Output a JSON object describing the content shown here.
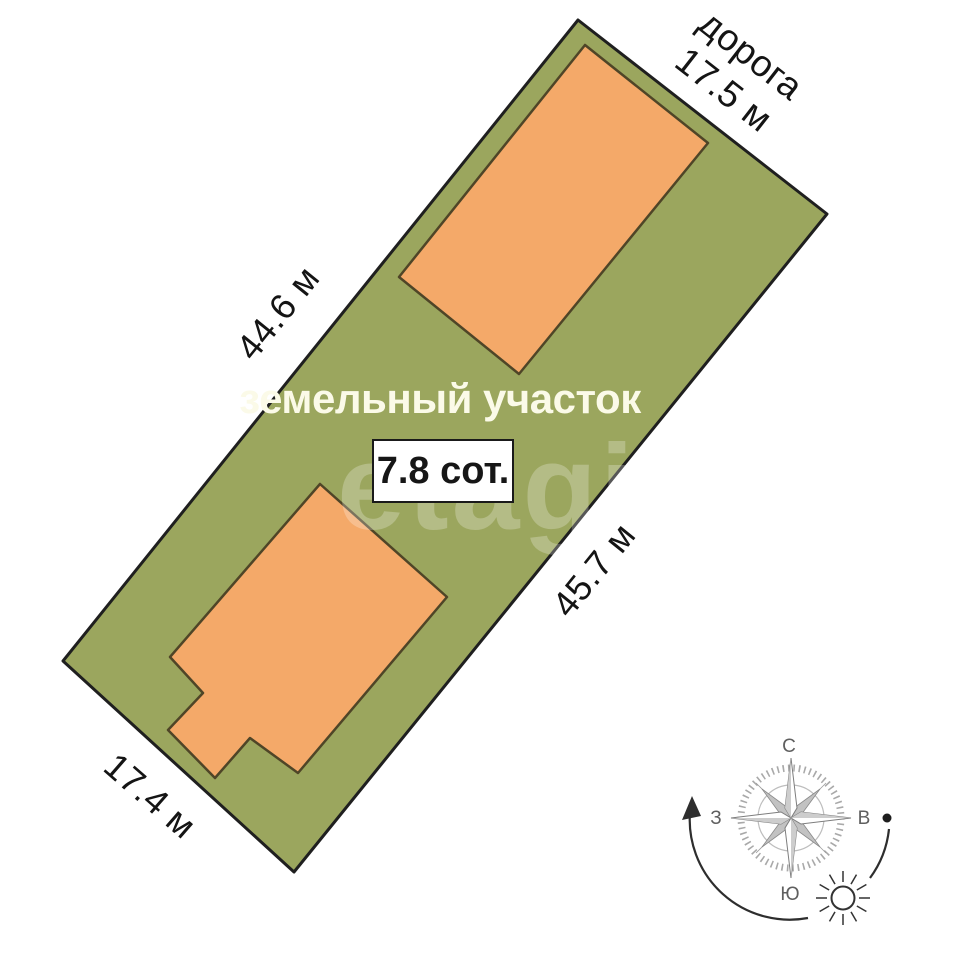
{
  "plot": {
    "title": "земельный участок",
    "area": "7.8 сот.",
    "road_label": "дорога",
    "road_side": "17.5 м",
    "left_side": "44.6 м",
    "right_side": "45.7 м",
    "bottom_side": "17.4 м"
  },
  "compass": {
    "north": "С",
    "east": "В",
    "south": "Ю",
    "west": "З"
  },
  "watermark": "etagi",
  "colors": {
    "land_fill": "#9ba65e",
    "land_border": "#1f1f1f",
    "building_fill": "#f4a969",
    "building_border": "#4f4527",
    "title_text": "#fbfae8",
    "dimension_text": "#141414",
    "compass_gray": "#9a9a9a",
    "compass_point_shade": "#cdcdcd",
    "compass_point_dark": "#c2c2c2",
    "arc_stroke": "#2e2e2e"
  }
}
